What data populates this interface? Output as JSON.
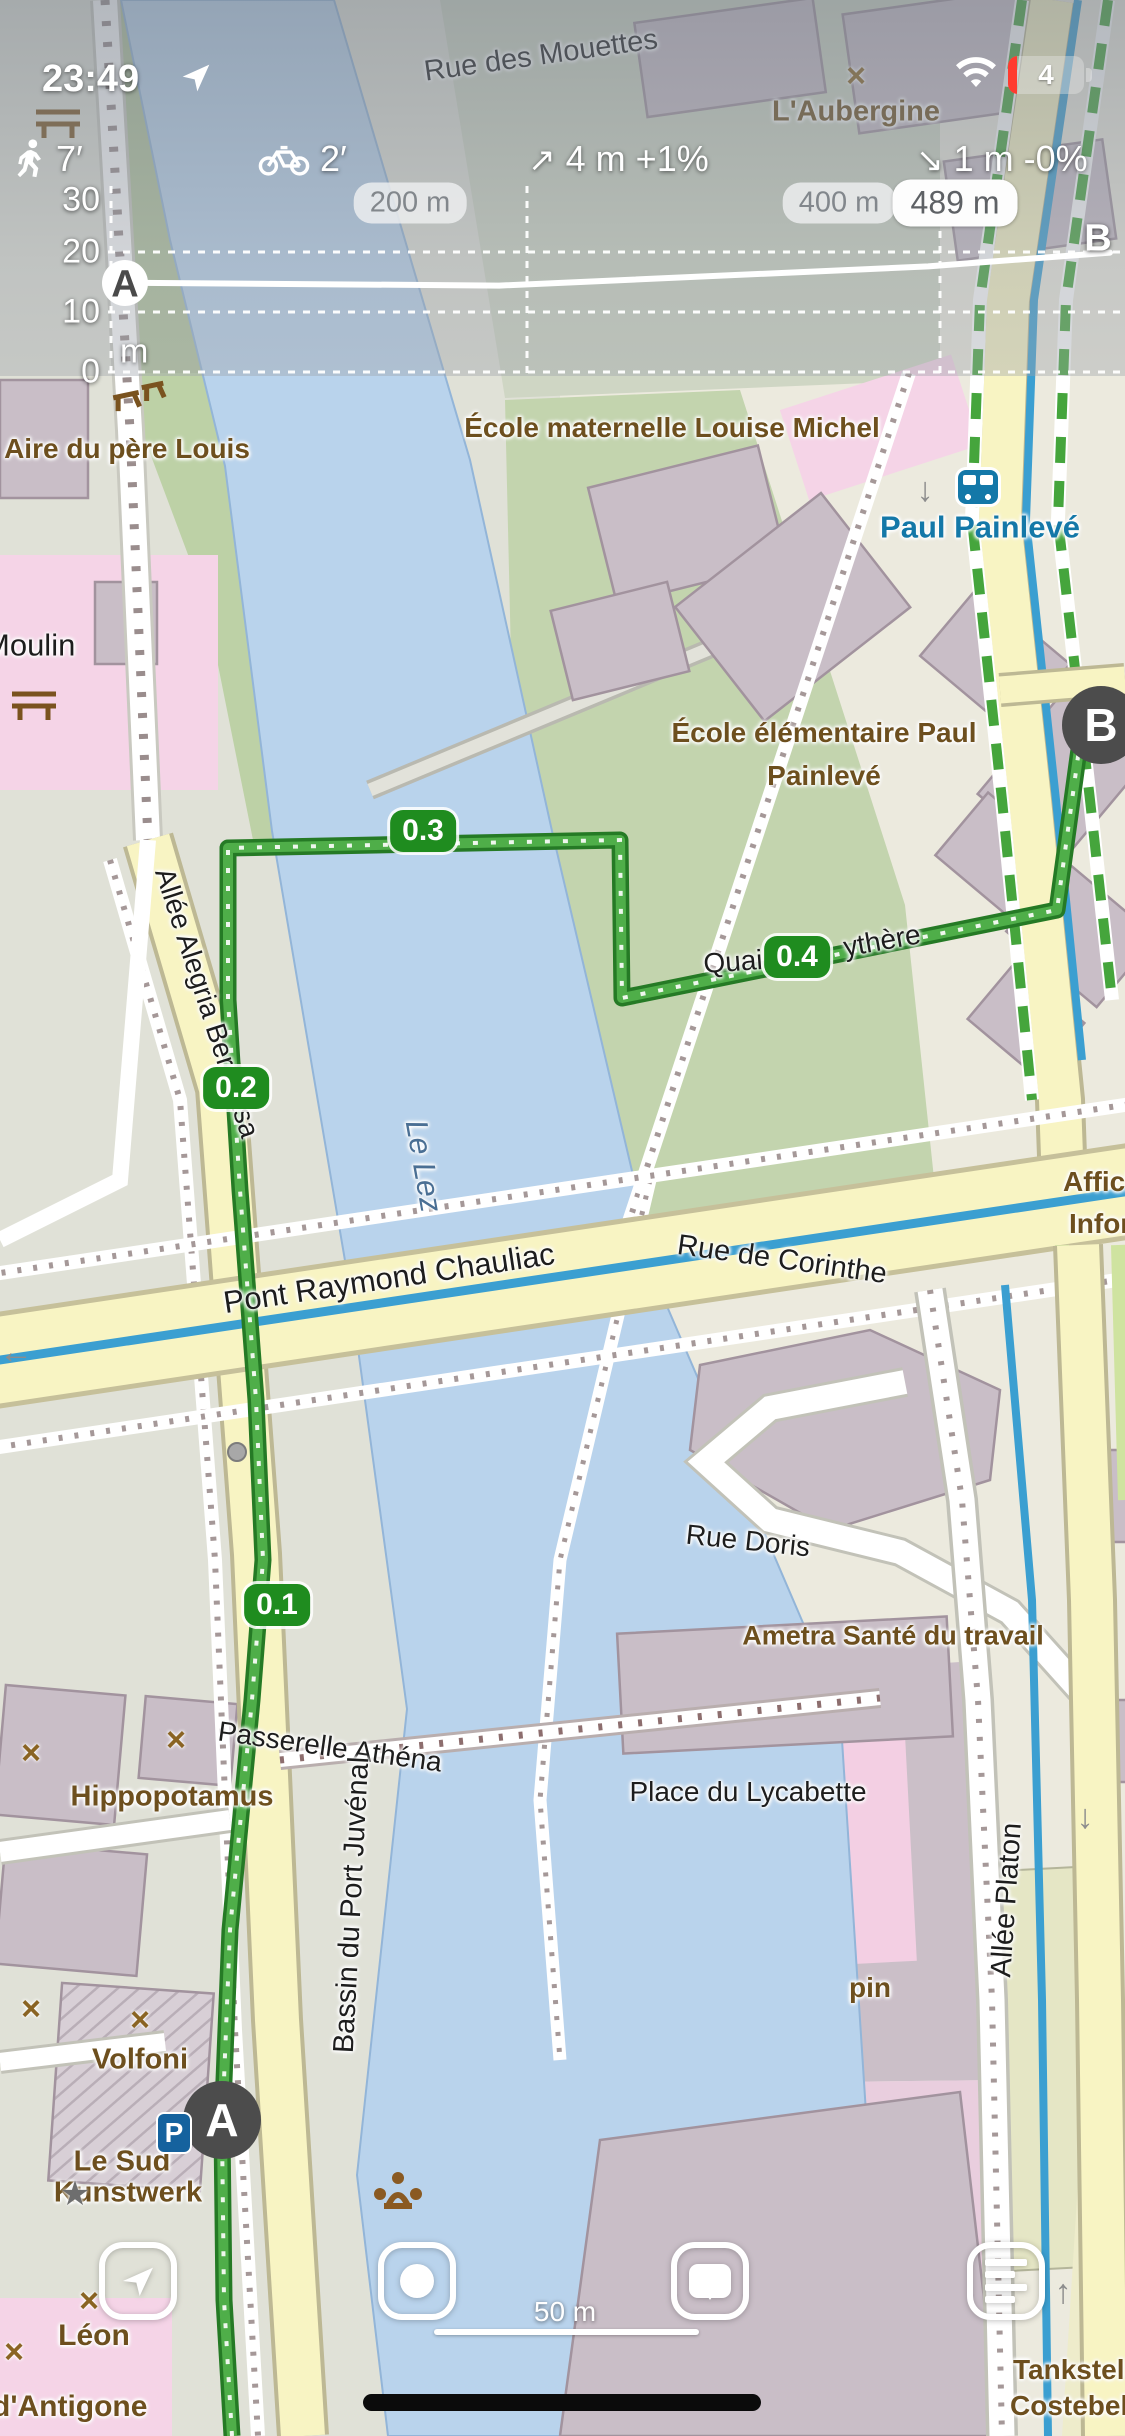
{
  "status_bar": {
    "time": "23:49",
    "battery_level": "4"
  },
  "route_info": {
    "walk_time": "7′",
    "bike_time": "2′",
    "ascent_icon": "↗",
    "ascent": "4 m +1%",
    "descent_icon": "↘",
    "descent": "1 m -0%"
  },
  "chart_data": {
    "type": "line",
    "title": "Route elevation profile",
    "ylabel": "m",
    "ylim": [
      0,
      35
    ],
    "y_ticks": [
      30,
      20,
      10,
      0
    ],
    "x_total_m": 489,
    "x_pills": [
      {
        "text": "200 m",
        "x": 410,
        "final": false
      },
      {
        "text": "400 m",
        "x": 839,
        "final": false
      },
      {
        "text": "489 m",
        "x": 955,
        "final": true
      }
    ],
    "start_label": "A",
    "end_label": "B",
    "points": [
      {
        "d": 0,
        "ele": 14.9
      },
      {
        "d": 190,
        "ele": 14.4
      },
      {
        "d": 400,
        "ele": 17.6
      },
      {
        "d": 489,
        "ele": 19.9
      }
    ]
  },
  "map": {
    "labels": [
      {
        "id": "rue-des-mouettes",
        "text": "Rue des Mouettes",
        "x": 541,
        "y": 56,
        "rot": -8,
        "fs": 29,
        "cls": "street"
      },
      {
        "id": "laubergine",
        "text": "L'Aubergine",
        "x": 856,
        "y": 112,
        "fs": 29,
        "cls": "poi"
      },
      {
        "id": "aire-du-pere-louis",
        "text": "Aire du père Louis",
        "x": 127,
        "y": 449,
        "fs": 28,
        "cls": "poi"
      },
      {
        "id": "ecole-maternelle",
        "text": "École maternelle Louise Michel",
        "x": 672,
        "y": 428,
        "fs": 28,
        "cls": "poi"
      },
      {
        "id": "paul-painleve",
        "text": "Paul Painlevé",
        "x": 980,
        "y": 527,
        "fs": 31,
        "cls": "transit"
      },
      {
        "id": "moulin",
        "text": "Moulin",
        "x": -16,
        "y": 645,
        "fs": 31,
        "cls": "street",
        "anchor": "left"
      },
      {
        "id": "ecole-elementaire-1",
        "text": "École élémentaire Paul",
        "x": 824,
        "y": 733,
        "fs": 28,
        "cls": "poi"
      },
      {
        "id": "ecole-elementaire-2",
        "text": "Painlevé",
        "x": 824,
        "y": 776,
        "fs": 28,
        "cls": "poi"
      },
      {
        "id": "quai",
        "text": "Quai",
        "x": 733,
        "y": 962,
        "rot": -4,
        "fs": 28,
        "cls": "street"
      },
      {
        "id": "ythere",
        "text": "ythère",
        "x": 882,
        "y": 941,
        "rot": -10,
        "fs": 28,
        "cls": "street"
      },
      {
        "id": "allee-alegria-beracasa",
        "text": "Allée Alegria Beracasa",
        "x": 207,
        "y": 1003,
        "rot": 72,
        "fs": 28,
        "cls": "street"
      },
      {
        "id": "le-lez",
        "text": "Le Lez",
        "x": 424,
        "y": 1166,
        "rot": 80,
        "fs": 31,
        "cls": "water"
      },
      {
        "id": "affichag",
        "text": "Affichag",
        "x": 1063,
        "y": 1182,
        "fs": 28,
        "cls": "poi",
        "anchor": "left"
      },
      {
        "id": "informati",
        "text": "Informati",
        "x": 1069,
        "y": 1224,
        "fs": 28,
        "cls": "poi",
        "anchor": "left"
      },
      {
        "id": "pont-raymond-chauliac",
        "text": "Pont Raymond Chauliac",
        "x": 389,
        "y": 1278,
        "rot": -8.5,
        "fs": 31,
        "cls": "street"
      },
      {
        "id": "rue-de-corinthe",
        "text": "Rue de Corinthe",
        "x": 782,
        "y": 1260,
        "rot": 8,
        "fs": 29,
        "cls": "street"
      },
      {
        "id": "rue-doris",
        "text": "Rue Doris",
        "x": 748,
        "y": 1541,
        "rot": 6,
        "fs": 28,
        "cls": "street"
      },
      {
        "id": "ametra-sante",
        "text": "Ametra Santé du travail",
        "x": 893,
        "y": 1636,
        "fs": 27,
        "cls": "poi"
      },
      {
        "id": "passerelle-athena",
        "text": "Passerelle Athéna",
        "x": 330,
        "y": 1747,
        "rot": 8,
        "fs": 28,
        "cls": "street"
      },
      {
        "id": "hippopotamus",
        "text": "Hippopotamus",
        "x": 172,
        "y": 1797,
        "fs": 29,
        "cls": "poi"
      },
      {
        "id": "place-du-lycabette",
        "text": "Place du Lycabette",
        "x": 748,
        "y": 1792,
        "fs": 28,
        "cls": "street"
      },
      {
        "id": "allee-platon",
        "text": "Allée Platon",
        "x": 1007,
        "y": 1900,
        "rot": -86,
        "fs": 29,
        "cls": "street"
      },
      {
        "id": "bassin-du-port-juvenal",
        "text": "Bassin du Port Juvénal",
        "x": 352,
        "y": 1905,
        "rot": -87,
        "fs": 29,
        "cls": "street"
      },
      {
        "id": "pin",
        "text": "pin",
        "x": 870,
        "y": 1988,
        "fs": 28,
        "cls": "poi"
      },
      {
        "id": "volfoni",
        "text": "Volfoni",
        "x": 140,
        "y": 2060,
        "fs": 29,
        "cls": "poi"
      },
      {
        "id": "le-sud",
        "text": "Le Sud",
        "x": 122,
        "y": 2162,
        "fs": 29,
        "cls": "poi"
      },
      {
        "id": "kunstwerk",
        "text": "Kunstwerk",
        "x": 128,
        "y": 2193,
        "fs": 29,
        "cls": "poi"
      },
      {
        "id": "leon",
        "text": "Léon",
        "x": 94,
        "y": 2336,
        "fs": 30,
        "cls": "poi"
      },
      {
        "id": "dantigone",
        "text": "d'Antigone",
        "x": -8,
        "y": 2407,
        "fs": 30,
        "cls": "poi",
        "anchor": "left"
      },
      {
        "id": "tankstel",
        "text": "Tankstel",
        "x": 1013,
        "y": 2370,
        "fs": 28,
        "cls": "poi",
        "anchor": "left"
      },
      {
        "id": "costebel",
        "text": "Costebel",
        "x": 1010,
        "y": 2406,
        "fs": 28,
        "cls": "poi",
        "anchor": "left"
      }
    ],
    "badges": [
      {
        "id": "badge-0-1",
        "label": "0.1",
        "x": 277,
        "y": 1605
      },
      {
        "id": "badge-0-2",
        "label": "0.2",
        "x": 236,
        "y": 1088
      },
      {
        "id": "badge-0-3",
        "label": "0.3",
        "x": 423,
        "y": 831
      },
      {
        "id": "badge-0-4",
        "label": "0.4",
        "x": 797,
        "y": 957
      }
    ],
    "markers": [
      {
        "id": "start",
        "label": "A",
        "x": 222,
        "y": 2120
      },
      {
        "id": "end",
        "label": "B",
        "x": 1101,
        "y": 725
      }
    ],
    "icons": [
      {
        "name": "cross-icon",
        "glyph": "×",
        "cls": "icon-cross",
        "x": 856,
        "y": 76
      },
      {
        "name": "cross-icon",
        "glyph": "×",
        "cls": "icon-cross",
        "x": 31,
        "y": 1753
      },
      {
        "name": "cross-icon",
        "glyph": "×",
        "cls": "icon-cross",
        "x": 176,
        "y": 1740
      },
      {
        "name": "cross-icon",
        "glyph": "×",
        "cls": "icon-cross",
        "x": 31,
        "y": 2009
      },
      {
        "name": "cross-icon",
        "glyph": "×",
        "cls": "icon-cross",
        "x": 140,
        "y": 2020
      },
      {
        "name": "cross-icon",
        "glyph": "×",
        "cls": "icon-cross",
        "x": 89,
        "y": 2301
      },
      {
        "name": "cross-icon",
        "glyph": "×",
        "cls": "icon-cross",
        "x": 14,
        "y": 2352
      },
      {
        "name": "star-icon",
        "glyph": "★",
        "cls": "icon-star",
        "x": 75,
        "y": 2194
      },
      {
        "name": "oneway-down-icon",
        "glyph": "↓",
        "cls": "icon-oneway",
        "x": 925,
        "y": 490
      },
      {
        "name": "oneway-down-icon",
        "glyph": "↓",
        "cls": "icon-oneway",
        "x": 1085,
        "y": 1817
      },
      {
        "name": "oneway-up-icon",
        "glyph": "↑",
        "cls": "icon-oneway",
        "x": 1063,
        "y": 2292
      },
      {
        "name": "oneway-left-icon",
        "glyph": "←",
        "cls": "icon-oneway",
        "x": 16,
        "y": 1352
      }
    ],
    "parking_label": "P"
  },
  "bottom_bar": {
    "scale_label": "50 m"
  }
}
